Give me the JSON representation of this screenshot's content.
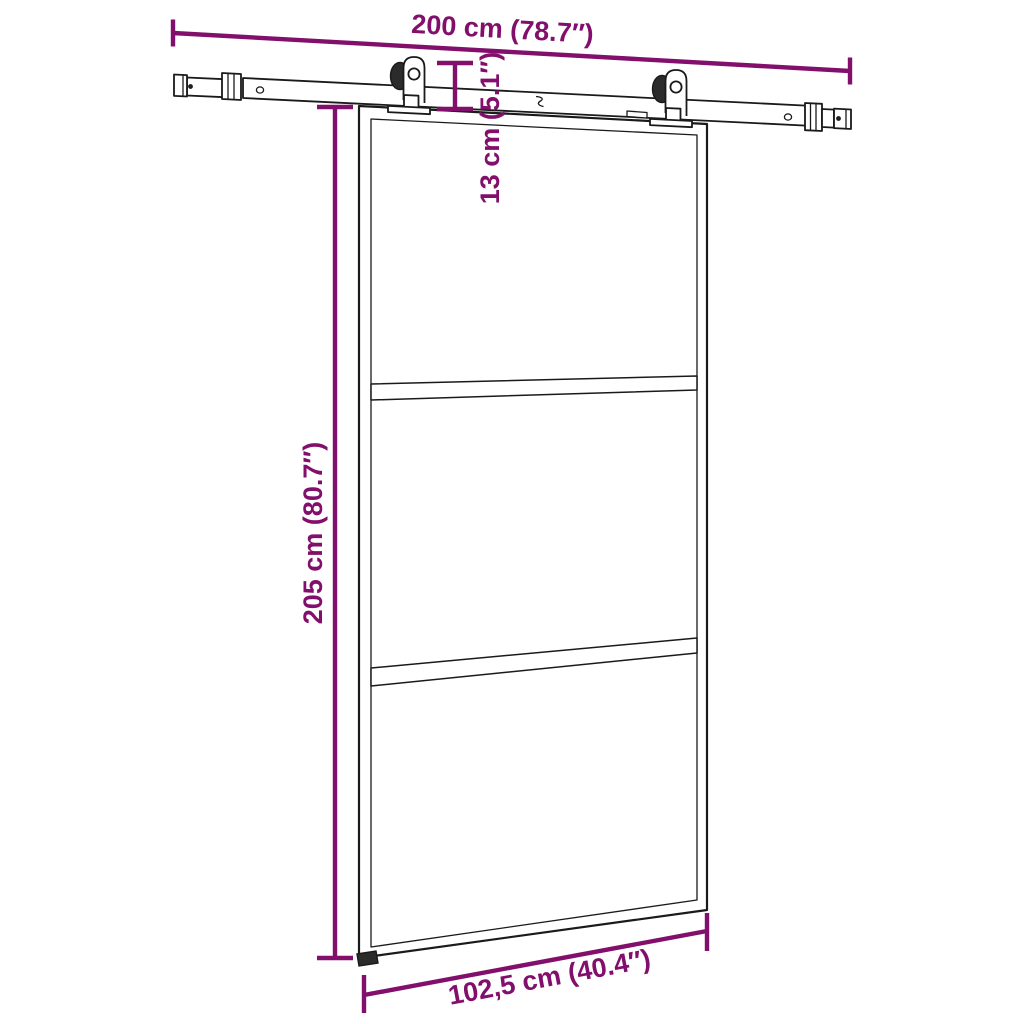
{
  "dimensions": {
    "rail_width": {
      "label": "200 cm (78.7″)"
    },
    "rail_to_door": {
      "label": "13 cm (5.1″)"
    },
    "door_height": {
      "label": "205 cm (80.7″)"
    },
    "door_width": {
      "label": "102,5 cm (40.4″)"
    }
  },
  "colors": {
    "accent": "#820F6B",
    "line": "#1A1A1A",
    "background": "#FFFFFF"
  }
}
